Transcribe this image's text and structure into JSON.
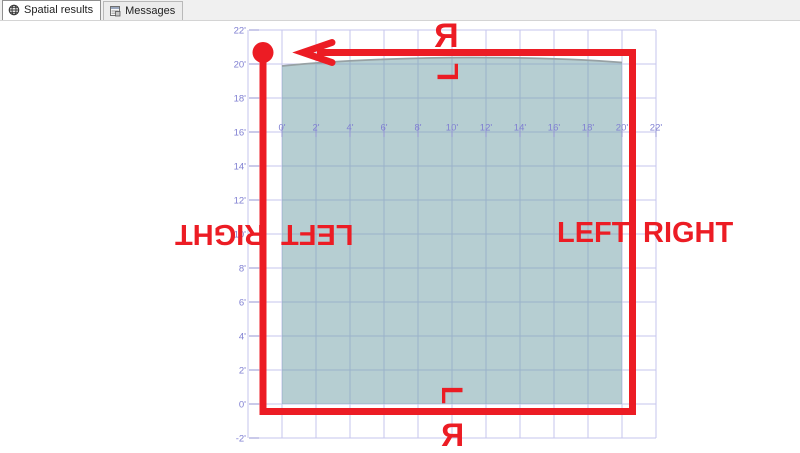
{
  "tabs": [
    {
      "label": "Spatial results",
      "icon": "globe-icon",
      "active": true
    },
    {
      "label": "Messages",
      "icon": "messages-icon",
      "active": false
    }
  ],
  "plot": {
    "x_axis": {
      "labels": [
        "0'",
        "2'",
        "4'",
        "6'",
        "8'",
        "10'",
        "12'",
        "14'",
        "16'",
        "18'",
        "20'",
        "22'"
      ]
    },
    "y_axis": {
      "labels": [
        "22'",
        "20'",
        "18'",
        "16'",
        "14'",
        "12'",
        "10'",
        "8'",
        "6'",
        "4'",
        "2'",
        "0'",
        "-2'"
      ]
    }
  },
  "chart_data": {
    "type": "area",
    "grid": "on",
    "x_range_ft": [
      -2,
      22
    ],
    "y_range_ft": [
      -2,
      22
    ],
    "polygon": {
      "x_min_ft": 0,
      "x_max_ft": 20,
      "y_min_ft": 0,
      "y_max_ft": 20,
      "shape_note": "square region, top edge slightly arched"
    }
  },
  "annotations": {
    "left_outer": "RIGHT",
    "left_inner": "LEFT",
    "right_inner": "LEFT",
    "right_outer": "RIGHT",
    "top_upper": "R",
    "top_lower": "L",
    "bottom_upper": "L",
    "bottom_lower": "R"
  },
  "colors": {
    "annotation_red": "#ec1c24",
    "grid_line": "#c6c6ee",
    "axis_tick": "#9595d5",
    "axis_label": "#7f7fd2",
    "polygon_fill": "rgba(110,158,165,0.5)",
    "polygon_edge": "#97a1a4",
    "tabbar_bg": "#f0f0f0",
    "active_tab_bg": "#ffffff"
  }
}
